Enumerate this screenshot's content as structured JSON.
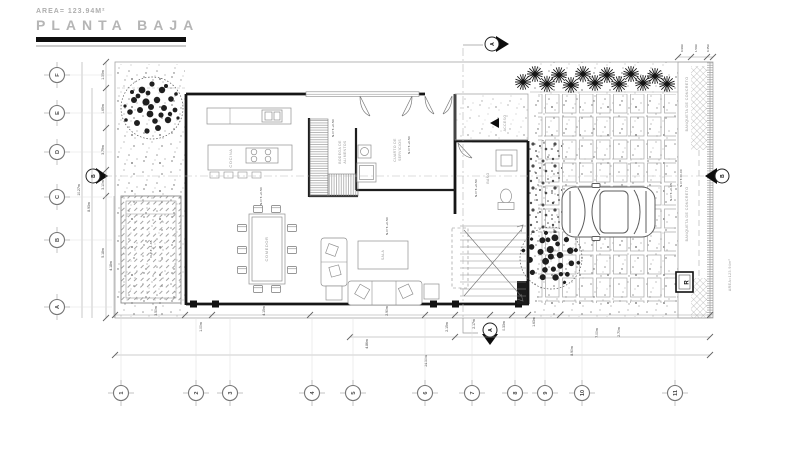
{
  "title": {
    "area": "AREA= 123.94M²",
    "name": "PLANTA BAJA"
  },
  "grid": {
    "letters": [
      "F",
      "E",
      "D",
      "C",
      "B",
      "A"
    ],
    "numbers": [
      "1",
      "2",
      "3",
      "4",
      "5",
      "6",
      "7",
      "8",
      "9",
      "10",
      "11"
    ]
  },
  "sections": {
    "a": "A",
    "b": "B"
  },
  "rooms": {
    "cocina": "COCINA",
    "comedor": "COMEDOR",
    "sala": "SALA",
    "bano": "BAÑO",
    "cuarto1": "CUARTO DE",
    "cuarto2": "SERVICIOS",
    "bodega1": "BODEGA DE",
    "bodega2": "ALIMENTOS",
    "acceso": "ACCESO"
  },
  "site": {
    "banqueta1": "BANQUETA DE CONCRETO",
    "banqueta2": "BANQUETA DE CONCRETO",
    "area_note": "AREA=123.94m²",
    "meter": "R"
  },
  "levels": {
    "l1": "N.P.T.+0.50",
    "l2": "N.P.T.+0.50",
    "l3": "N.P.T.+0.50",
    "l4": "N.P.T.+0.50",
    "l5": "N.P.T.+0.50",
    "l6": "N.P.T.+0.05",
    "l7": "N.P.T.±0.00",
    "l8": "N.P.T.-1.35"
  },
  "dims": {
    "left": {
      "d1": "1.35m",
      "d2": "1.65m",
      "d3": "3.79m",
      "d4": "3.10m",
      "d5": "5.18m",
      "d6": "4.18m",
      "d7": "8.93m",
      "d8": "10.27m"
    },
    "bottom": {
      "b1": "3.50m",
      "b2": "1.00m",
      "b3": "4.15m",
      "b4": "2.90m",
      "b5": "2.15m",
      "b6": "2.17m",
      "b7": "0.33m",
      "b8": "1.63m",
      "b9": "4.86m",
      "b10": "7.00m",
      "b11": "2.70m",
      "b12": "8.90m",
      "b13": "24.50m"
    },
    "right": {
      "r1": "0.90m",
      "r2": "1.50m",
      "r3": "0.45m"
    }
  }
}
